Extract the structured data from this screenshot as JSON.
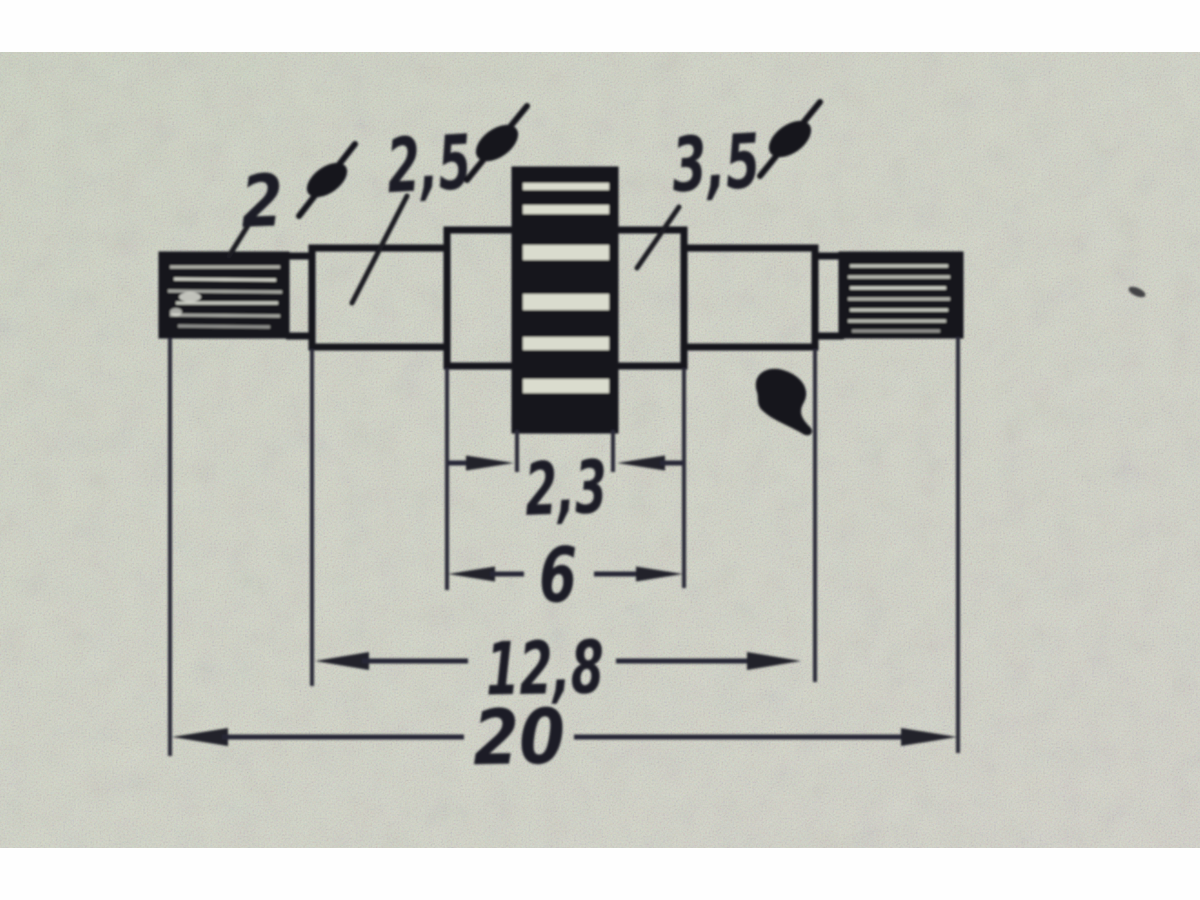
{
  "figure": {
    "kind": "photographed technical drawing",
    "subject": "stepped shaft with knurled ends and striped worm-gear section"
  },
  "callouts": {
    "d2": {
      "value": "2",
      "symbol": "⌀"
    },
    "d25": {
      "value": "2,5",
      "symbol": "⌀"
    },
    "d35": {
      "value": "3,5",
      "symbol": "⌀"
    }
  },
  "dimensions": {
    "w23": {
      "value": "2,3"
    },
    "w6": {
      "value": "6"
    },
    "w128": {
      "value": "12,8"
    },
    "w20": {
      "value": "20"
    }
  },
  "colors": {
    "paper": "#d3d6c7",
    "margin": "#ffffff",
    "ink": "#1a1a22",
    "dim_line_ink": "#262734"
  }
}
